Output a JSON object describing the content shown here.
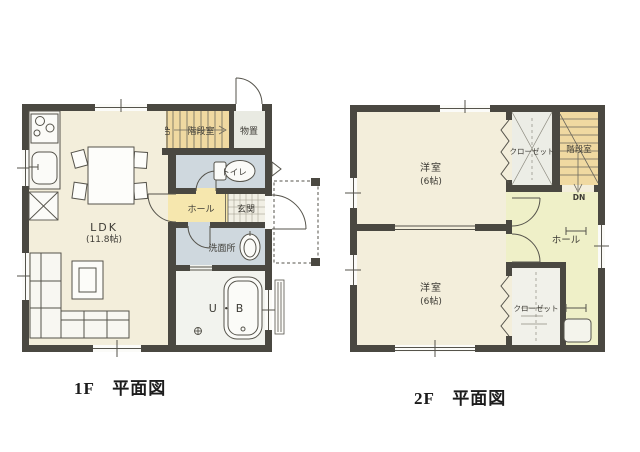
{
  "colors": {
    "wall": "#4a4841",
    "floor_cream": "#f3eedb",
    "hall_yellow": "#f6e7ae",
    "stairs_tan": "#f0d9a1",
    "wet_blue": "#cfd8de",
    "storage_gray": "#e9eae2",
    "hall2_green": "#eff0c8",
    "bath_white": "#f2f3ee",
    "line": "#55534b"
  },
  "floor1": {
    "caption": "1F　平面図",
    "rooms": {
      "ldk": {
        "name": "LDK",
        "size": "(11.8帖)"
      },
      "hall": {
        "name": "ホール"
      },
      "entrance": {
        "name": "玄関"
      },
      "toilet": {
        "name": "トイレ"
      },
      "washroom": {
        "name": "洗面所"
      },
      "bath": {
        "name": "U・B"
      },
      "storage": {
        "name": "物置"
      },
      "stairwell": {
        "name": "階段室",
        "direction_label": "UP"
      }
    }
  },
  "floor2": {
    "caption": "2F　平面図",
    "rooms": {
      "bedroom_top": {
        "name": "洋室",
        "size": "(6帖)"
      },
      "bedroom_bottom": {
        "name": "洋室",
        "size": "(6帖)"
      },
      "closet_top": {
        "name": "クローゼット"
      },
      "closet_bottom": {
        "name": "クローゼット"
      },
      "hall": {
        "name": "ホール"
      },
      "stairwell": {
        "name": "階段室",
        "direction_label": "DN"
      }
    }
  }
}
